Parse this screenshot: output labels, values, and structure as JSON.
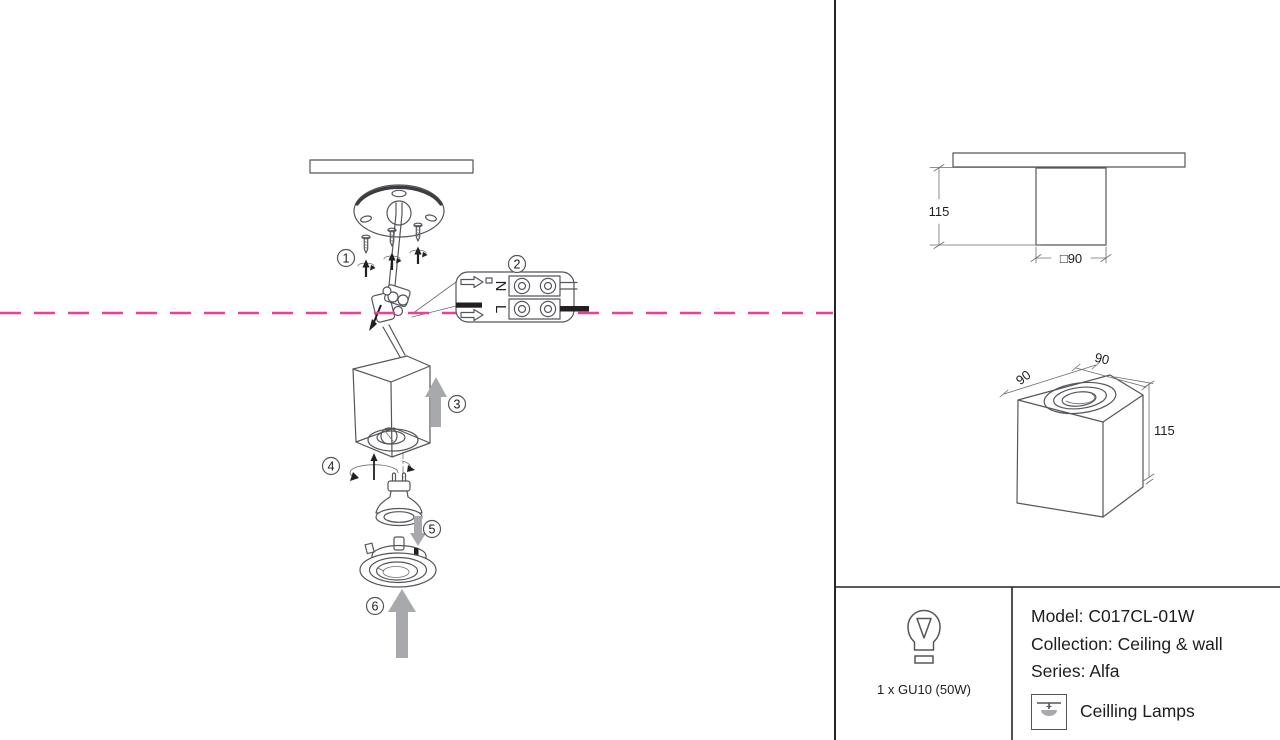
{
  "colors": {
    "line": "#55565a",
    "text": "#1d1d1f",
    "accent_pink": "#ec3f96",
    "arrow_gray": "#a7a9ac",
    "divider": "#242425"
  },
  "install_diagram": {
    "steps": [
      "1",
      "2",
      "3",
      "4",
      "5",
      "6"
    ],
    "terminal_labels": {
      "neutral": "N",
      "live": "L"
    }
  },
  "dimension_views": {
    "front": {
      "height": "115",
      "width": "□90"
    },
    "iso": {
      "depth": "90",
      "width": "90",
      "height": "115"
    }
  },
  "spec_panel": {
    "bulb_caption": "1 x GU10 (50W)",
    "model": "Model: C017CL-01W",
    "collection": "Collection: Ceiling & wall",
    "series": "Series: Alfa",
    "category": "Ceilling Lamps"
  }
}
